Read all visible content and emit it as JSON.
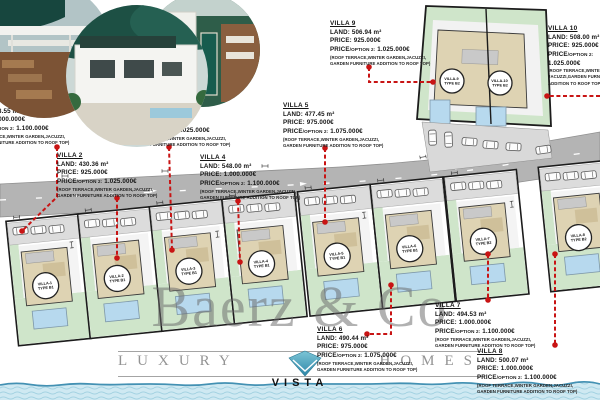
{
  "watermark": {
    "brand": "Baerz & Co",
    "tagline_left": "LUXURY",
    "tagline_right": "HOMES",
    "logo_label": "VISTA"
  },
  "colors": {
    "leader_red": "#c81414",
    "road_gray": "#b4b4b4",
    "lawn_green": "#cfe5ca",
    "building_beige": "#ded3b3",
    "pool_blue": "#b7d9ee",
    "sea_blue": "#cfe9f2",
    "watermark_gray": "#6e6e6e",
    "logo_teal": "#3f9ab5"
  },
  "villas": [
    {
      "title": "VILLA 1",
      "land": "LAND: 478.55 m²",
      "price": "PRICE: 1.000.000€",
      "option_prefix": "PRICE",
      "option_label": "/OPTION 2:",
      "option_value": " 1.100.000€",
      "notes": [
        "(ROOF TERRACE,WINTER GARDEN,JACUZZI,",
        "GARDEN FURNITURE ADDITION TO ROOF TOP)"
      ]
    },
    {
      "title": "VILLA 2",
      "land": "LAND: 430.36 m²",
      "price": "PRICE: 925.000€",
      "option_prefix": "PRICE",
      "option_label": "/OPTION 2:",
      "option_value": " 1.025.000€",
      "notes": [
        "(ROOF TERRACE,WINTER GARDEN,JACUZZI,",
        "GARDEN FURNITURE ADDITION TO ROOF TOP)"
      ]
    },
    {
      "title": "VILLA 3",
      "land": "LAND: 400.71 m²",
      "price": "PRICE: 925.000€",
      "option_prefix": "PRICE",
      "option_label": "/OPTION 2:",
      "option_value": " 1.025.000€",
      "notes": [
        "(ROOF TERRACE,WINTER GARDEN,JACUZZI,",
        "GARDEN FURNITURE ADDITION TO ROOF TOP)"
      ]
    },
    {
      "title": "VILLA 4",
      "land": "LAND: 548.00 m²",
      "price": "PRICE: 1.000.000€",
      "option_prefix": "PRICE",
      "option_label": "/OPTION 2:",
      "option_value": " 1.100.000€",
      "notes": [
        "(ROOF TERRACE,WINTER GARDEN,JACUZZI,",
        "GARDEN FURNITURE ADDITION TO ROOF TOP)"
      ]
    },
    {
      "title": "VILLA 5",
      "land": "LAND: 477.45 m²",
      "price": "PRICE: 975.000€",
      "option_prefix": "PRICE",
      "option_label": "/OPTION 2:",
      "option_value": " 1.075.000€",
      "notes": [
        "(ROOF TERRACE,WINTER GARDEN,JACUZZI,",
        "GARDEN FURNITURE ADDITION TO ROOF TOP)"
      ]
    },
    {
      "title": "VILLA 6",
      "land": "LAND: 490.44 m²",
      "price": "PRICE: 975.000€",
      "option_prefix": "PRICE",
      "option_label": "/OPTION 2:",
      "option_value": " 1.075.000€",
      "notes": [
        "(ROOF TERRACE,WINTER GARDEN,JACUZZI,",
        "GARDEN FURNITURE ADDITION TO ROOF TOP)"
      ]
    },
    {
      "title": "VILLA 7",
      "land": "LAND: 494.53 m²",
      "price": "PRICE: 1.000.000€",
      "option_prefix": "PRICE",
      "option_label": "/OPTION 2:",
      "option_value": " 1.100.000€",
      "notes": [
        "(ROOF TERRACE,WINTER GARDEN,JACUZZI,",
        "GARDEN FURNITURE ADDITION TO ROOF TOP)"
      ]
    },
    {
      "title": "VILLA 8",
      "land": "LAND: 500.07 m²",
      "price": "PRICE: 1.000.000€",
      "option_prefix": "PRICE",
      "option_label": "/OPTION 2:",
      "option_value": " 1.100.000€",
      "notes": [
        "(ROOF TERRACE,WINTER GARDEN,JACUZZI,",
        "GARDEN FURNITURE ADDITION TO ROOF TOP)"
      ]
    },
    {
      "title": "VILLA 9",
      "land": "LAND: 506.94 m²",
      "price": "PRICE: 925.000€",
      "option_prefix": "PRICE",
      "option_label": "/OPTION 2:",
      "option_value": " 1.025.000€",
      "notes": [
        "(ROOF TERRACE,WINTER GARDEN,JACUZZI,",
        "GARDEN FURNITURE ADDITION TO ROOF TOP)"
      ]
    },
    {
      "title": "VILLA 10",
      "land": "LAND: 508.00 m²",
      "price": "PRICE: 925.000€",
      "option_prefix": "PRICE",
      "option_label": "/OPTION 2:",
      "option_value": "1.025.000€",
      "notes": [
        "(ROOF TERRACE,WINTER",
        "JACUZZI,GARDEN FURNITURE",
        "ADDITION TO ROOF TOP)"
      ]
    }
  ],
  "plan": {
    "plots": [
      {
        "l1": "VILLA-1",
        "l2": "TYPE B1"
      },
      {
        "l1": "VILLA-2",
        "l2": "TYPE B1"
      },
      {
        "l1": "VILLA-3",
        "l2": "TYPE B1"
      },
      {
        "l1": "VILLA-4",
        "l2": "TYPE B1"
      },
      {
        "l1": "VILLA-5",
        "l2": "TYPE B1"
      },
      {
        "l1": "VILLA-6",
        "l2": "TYPE B1"
      },
      {
        "l1": "VILLA-7",
        "l2": "TYPE B2"
      },
      {
        "l1": "VILLA-8",
        "l2": "TYPE B2"
      },
      {
        "l1": "VILLA-9",
        "l2": "TYPE B2"
      },
      {
        "l1": "VILLA-10",
        "l2": "TYPE B2"
      }
    ]
  }
}
